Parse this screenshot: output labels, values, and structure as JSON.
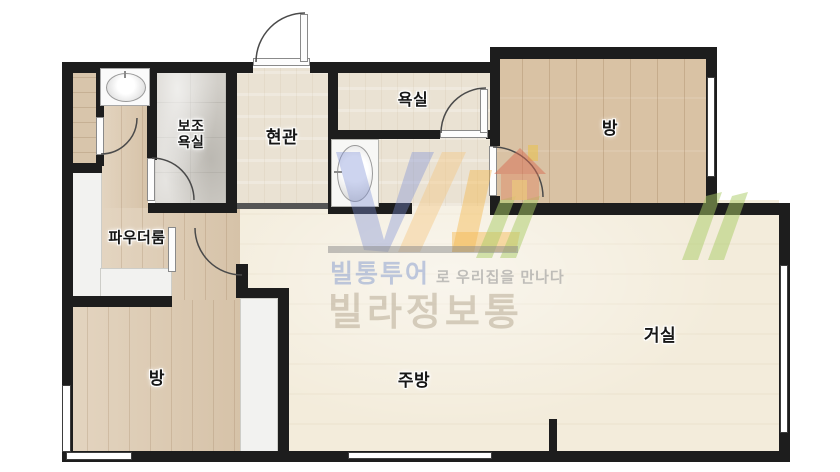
{
  "floorplan": {
    "labels": {
      "aux_bath": "보조\n욕실",
      "entry": "현관",
      "bath": "욕실",
      "bedroom_top": "방",
      "powder": "파우더룸",
      "bedroom_bottom": "방",
      "kitchen": "주방",
      "living": "거실"
    },
    "watermark": {
      "tagline_brand": "빌통투어",
      "tagline_rest": "로 우리집을 만나다",
      "brand": "빌라정보통"
    },
    "icons": {
      "washbasin": "washbasin-icon",
      "pedestal_basin": "pedestal-basin-icon",
      "house_logo": "house-icon"
    },
    "colors": {
      "wall": "#1d1d1d",
      "wood": "#dcc9af",
      "wood_bedroom": "#d9c2a4",
      "marble": "#d2cfc9",
      "tile": "#eae2d3",
      "cream": "#f3ecdb",
      "watermark_blue": "#7b8fd4",
      "watermark_yellow": "#f3b94d",
      "watermark_green": "#a9cc66",
      "watermark_gray": "#8a8a8a",
      "watermark_brand_text": "#b3a58e"
    }
  }
}
